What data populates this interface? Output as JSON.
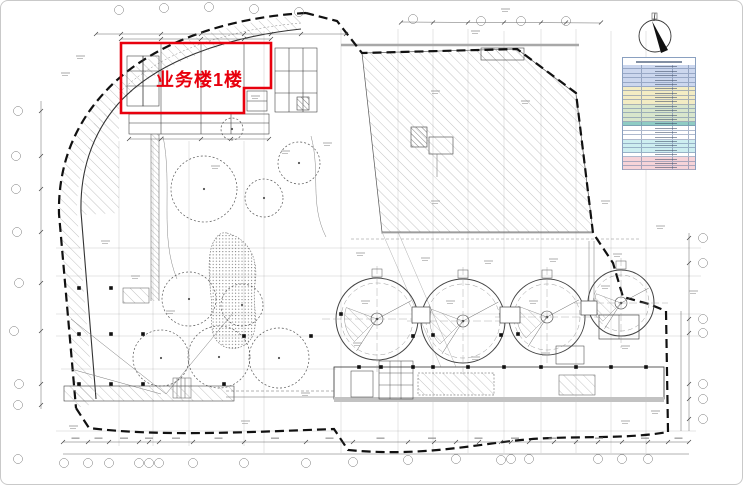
{
  "drawing": {
    "kind": "site-plan",
    "background": "#ffffff",
    "line_color": "#333333",
    "boundary_color": "#111111"
  },
  "highlight": {
    "label": "业务楼1楼",
    "color": "#e8000d"
  },
  "compass": {
    "shown": true
  },
  "stats_table": {
    "text_legible": false,
    "border_color": "#8aa0c0",
    "band_colors": {
      "blue": "#ccd7ee",
      "yellow": "#f3ecc3",
      "green": "#d8e6cc",
      "teal": "#8fccc4",
      "white": "#ffffff",
      "cyan": "#cdeef0",
      "pink": "#f6d3d8"
    },
    "bands": [
      {
        "band": "blue",
        "rows": 5
      },
      {
        "band": "yellow",
        "rows": 4
      },
      {
        "band": "green",
        "rows": 4
      },
      {
        "band": "teal",
        "rows": 1
      },
      {
        "band": "white",
        "rows": 3
      },
      {
        "band": "cyan",
        "rows": 3
      },
      {
        "band": "white",
        "rows": 1
      },
      {
        "band": "pink",
        "rows": 3
      }
    ]
  }
}
